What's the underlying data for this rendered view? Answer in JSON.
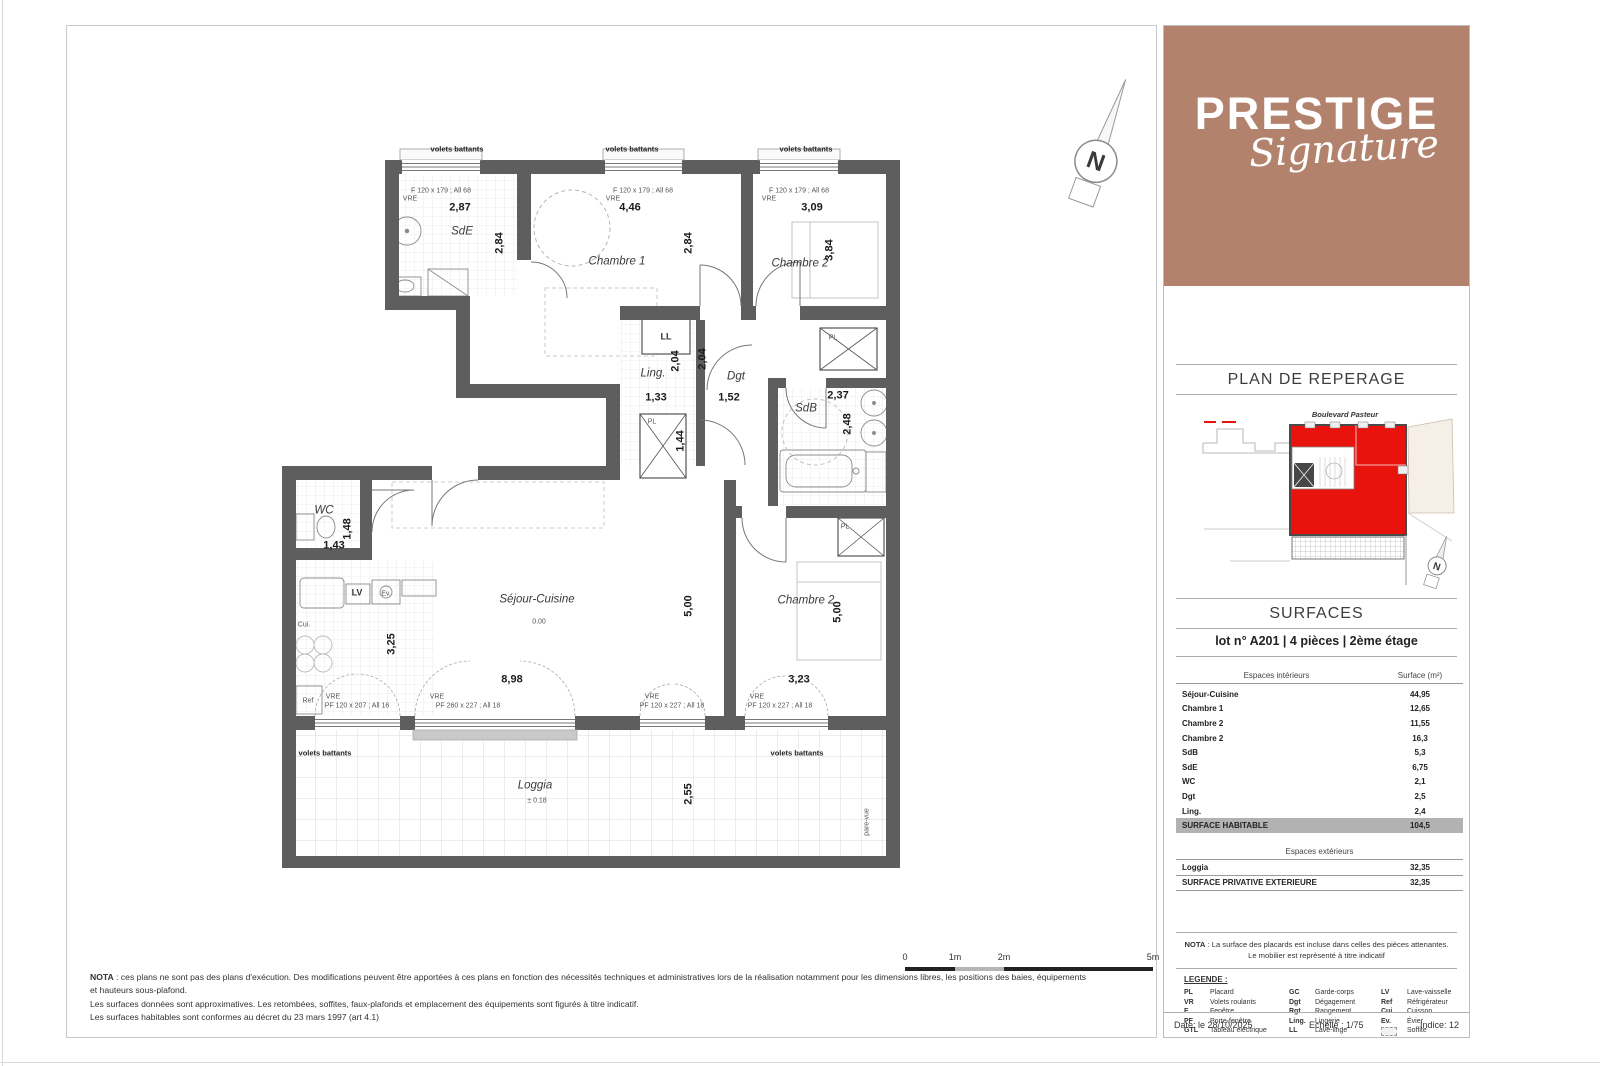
{
  "branding": {
    "title": "PRESTIGE",
    "subtitle": "Signature",
    "bg_color": "#b3826d"
  },
  "compass": {
    "letter": "N"
  },
  "reperage": {
    "title": "PLAN DE REPERAGE",
    "street": "Boulevard Pasteur",
    "unit_color": "#e8130d"
  },
  "surfaces": {
    "title": "SURFACES",
    "lot_line": "lot n° A201 | 4 pièces | 2ème étage",
    "interior_header": {
      "label": "Espaces intérieurs",
      "value": "Surface (m²)"
    },
    "interior_rows": [
      [
        "Séjour-Cuisine",
        "44,95"
      ],
      [
        "Chambre 1",
        "12,65"
      ],
      [
        "Chambre 2",
        "11,55"
      ],
      [
        "Chambre 2",
        "16,3"
      ],
      [
        "SdB",
        "5,3"
      ],
      [
        "SdE",
        "6,75"
      ],
      [
        "WC",
        "2,1"
      ],
      [
        "Dgt",
        "2,5"
      ],
      [
        "Ling.",
        "2,4"
      ]
    ],
    "habitable_row": [
      "SURFACE HABITABLE",
      "104,5"
    ],
    "exterior_header": "Espaces extérieurs",
    "exterior_rows": [
      [
        "Loggia",
        "32,35"
      ]
    ],
    "exterior_total_row": [
      "SURFACE PRIVATIVE EXTERIEURE",
      "32,35"
    ]
  },
  "nota_panel": {
    "bold": "NOTA",
    "text": " : La surface des placards est incluse dans celles des pièces attenantes. Le mobilier est représenté à titre indicatif"
  },
  "legend": {
    "title": "LEGENDE :",
    "entries": [
      [
        "PL",
        "Placard"
      ],
      [
        "VR",
        "Volets roulants"
      ],
      [
        "F",
        "Fenêtre"
      ],
      [
        "PF",
        "Porte-fenêtre"
      ],
      [
        "GTL",
        "Tableau électrique"
      ],
      [
        "GC",
        "Garde-corps"
      ],
      [
        "Dgt",
        "Dégagement"
      ],
      [
        "Rgt",
        "Rangement"
      ],
      [
        "Ling.",
        "Lingerie"
      ],
      [
        "LL",
        "Lave-linge"
      ],
      [
        "LV",
        "Lave-vaisselle"
      ],
      [
        "Ref",
        "Réfrigérateur"
      ],
      [
        "Cui.",
        "Cuisson"
      ],
      [
        "Ev.",
        "Évier"
      ],
      [
        "",
        "Soffite"
      ]
    ]
  },
  "footer": {
    "date": "Date: le 28/10/2025",
    "scale": "Echelle : 1/75",
    "index": "Indice: 12"
  },
  "nota_main": {
    "bold": "NOTA",
    "lines": [
      " : ces plans ne sont pas des plans d'exécution. Des modifications peuvent être apportées à ces plans en fonction des nécessités techniques et administratives lors de la réalisation notamment pour les dimensions libres, les positions des baies, équipements",
      "et hauteurs sous-plafond.",
      "Les surfaces données sont approximatives. Les retombées, soffites, faux-plafonds et emplacement des équipements sont figurés à titre indicatif.",
      "Les surfaces habitables sont conformes au décret du 23 mars 1997 (art 4.1)"
    ]
  },
  "scalebar": {
    "labels": [
      "0",
      "1m",
      "2m",
      "5m"
    ]
  },
  "plan": {
    "labels": [
      {
        "t": "volets battants",
        "x": 457,
        "y": 149,
        "c": "tiny-b"
      },
      {
        "t": "volets battants",
        "x": 632,
        "y": 149,
        "c": "tiny-b"
      },
      {
        "t": "volets battants",
        "x": 806,
        "y": 149,
        "c": "tiny-b"
      },
      {
        "t": "F 120 x 179 ; All 68",
        "x": 441,
        "y": 191,
        "c": "tiny"
      },
      {
        "t": "VRE",
        "x": 410,
        "y": 199,
        "c": "tiny"
      },
      {
        "t": "F 120 x 179 ; All 68",
        "x": 643,
        "y": 191,
        "c": "tiny"
      },
      {
        "t": "VRE",
        "x": 613,
        "y": 199,
        "c": "tiny"
      },
      {
        "t": "F 120 x 179 ; All 68",
        "x": 799,
        "y": 191,
        "c": "tiny"
      },
      {
        "t": "VRE",
        "x": 769,
        "y": 199,
        "c": "tiny"
      },
      {
        "t": "2,87",
        "x": 460,
        "y": 208,
        "c": "dim"
      },
      {
        "t": "4,46",
        "x": 630,
        "y": 208,
        "c": "dim"
      },
      {
        "t": "3,09",
        "x": 812,
        "y": 208,
        "c": "dim"
      },
      {
        "t": "SdE",
        "x": 462,
        "y": 232,
        "c": "room"
      },
      {
        "t": "Chambre 1",
        "x": 617,
        "y": 262,
        "c": "room"
      },
      {
        "t": "Chambre 2",
        "x": 800,
        "y": 264,
        "c": "room"
      },
      {
        "t": "2,84",
        "x": 500,
        "y": 243,
        "c": "dim",
        "r": 1
      },
      {
        "t": "2,84",
        "x": 689,
        "y": 243,
        "c": "dim",
        "r": 1
      },
      {
        "t": "3,84",
        "x": 830,
        "y": 250,
        "c": "dim",
        "r": 1
      },
      {
        "t": "LL",
        "x": 666,
        "y": 337,
        "c": "room-s"
      },
      {
        "t": "Ling.",
        "x": 653,
        "y": 374,
        "c": "room"
      },
      {
        "t": "Dgt",
        "x": 736,
        "y": 377,
        "c": "room"
      },
      {
        "t": "SdB",
        "x": 806,
        "y": 409,
        "c": "room"
      },
      {
        "t": "1,33",
        "x": 656,
        "y": 398,
        "c": "dim"
      },
      {
        "t": "1,52",
        "x": 729,
        "y": 398,
        "c": "dim"
      },
      {
        "t": "2,37",
        "x": 838,
        "y": 396,
        "c": "dim"
      },
      {
        "t": "2,04",
        "x": 676,
        "y": 361,
        "c": "dim",
        "r": 1
      },
      {
        "t": "2,04",
        "x": 703,
        "y": 359,
        "c": "dim",
        "r": 1
      },
      {
        "t": "2,48",
        "x": 848,
        "y": 424,
        "c": "dim",
        "r": 1
      },
      {
        "t": "1,44",
        "x": 681,
        "y": 441,
        "c": "dim",
        "r": 1
      },
      {
        "t": "PL",
        "x": 652,
        "y": 422,
        "c": "tiny"
      },
      {
        "t": "PL",
        "x": 833,
        "y": 338,
        "c": "tiny"
      },
      {
        "t": "PL",
        "x": 845,
        "y": 527,
        "c": "tiny"
      },
      {
        "t": "WC",
        "x": 324,
        "y": 511,
        "c": "room"
      },
      {
        "t": "1,43",
        "x": 334,
        "y": 546,
        "c": "dim"
      },
      {
        "t": "1,48",
        "x": 348,
        "y": 529,
        "c": "dim",
        "r": 1
      },
      {
        "t": "LV",
        "x": 357,
        "y": 593,
        "c": "room-s"
      },
      {
        "t": "Ev.",
        "x": 386,
        "y": 594,
        "c": "tiny"
      },
      {
        "t": "Cui.",
        "x": 304,
        "y": 625,
        "c": "tiny"
      },
      {
        "t": "Ref",
        "x": 308,
        "y": 701,
        "c": "tiny"
      },
      {
        "t": "Séjour-Cuisine",
        "x": 537,
        "y": 600,
        "c": "room"
      },
      {
        "t": "0.00",
        "x": 539,
        "y": 622,
        "c": "tiny"
      },
      {
        "t": "3,25",
        "x": 392,
        "y": 644,
        "c": "dim",
        "r": 1
      },
      {
        "t": "8,98",
        "x": 512,
        "y": 680,
        "c": "dim"
      },
      {
        "t": "5,00",
        "x": 689,
        "y": 606,
        "c": "dim",
        "r": 1
      },
      {
        "t": "Chambre 2",
        "x": 806,
        "y": 601,
        "c": "room"
      },
      {
        "t": "5,00",
        "x": 838,
        "y": 612,
        "c": "dim",
        "r": 1
      },
      {
        "t": "3,23",
        "x": 799,
        "y": 680,
        "c": "dim"
      },
      {
        "t": "VRE",
        "x": 333,
        "y": 697,
        "c": "tiny"
      },
      {
        "t": "PF 120 x 207 ; All 16",
        "x": 357,
        "y": 706,
        "c": "tiny"
      },
      {
        "t": "VRE",
        "x": 437,
        "y": 697,
        "c": "tiny"
      },
      {
        "t": "PF 260 x 227 ; All 18",
        "x": 468,
        "y": 706,
        "c": "tiny"
      },
      {
        "t": "VRE",
        "x": 652,
        "y": 697,
        "c": "tiny"
      },
      {
        "t": "PF 120 x 227 ; All 18",
        "x": 672,
        "y": 706,
        "c": "tiny"
      },
      {
        "t": "VRE",
        "x": 757,
        "y": 697,
        "c": "tiny"
      },
      {
        "t": "PF 120 x 227 ; All 18",
        "x": 780,
        "y": 706,
        "c": "tiny"
      },
      {
        "t": "volets battants",
        "x": 325,
        "y": 753,
        "c": "tiny-b"
      },
      {
        "t": "volets battants",
        "x": 797,
        "y": 753,
        "c": "tiny-b"
      },
      {
        "t": "Loggia",
        "x": 535,
        "y": 786,
        "c": "room"
      },
      {
        "t": "± 0.18",
        "x": 537,
        "y": 801,
        "c": "tiny"
      },
      {
        "t": "2,55",
        "x": 689,
        "y": 794,
        "c": "dim",
        "r": 1
      },
      {
        "t": "pare-vue",
        "x": 867,
        "y": 822,
        "c": "tiny",
        "r": 1
      }
    ]
  }
}
